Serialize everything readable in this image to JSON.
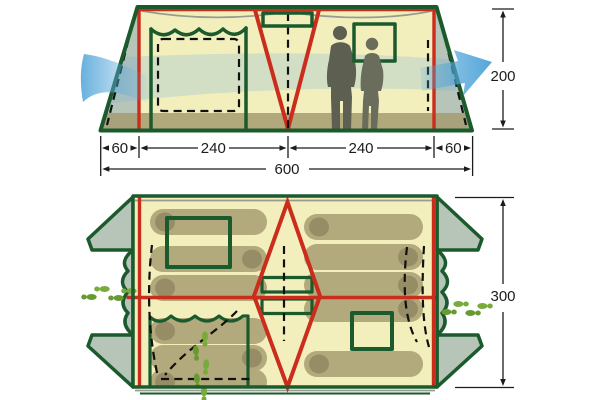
{
  "diagram": {
    "subject": "tent-specification-diagram",
    "views": {
      "front_elevation": "front-elevation-view",
      "floor_plan": "floor-plan-view"
    }
  },
  "dimensions": {
    "front_view": {
      "left_vestibule_width": "60",
      "left_room_width": "240",
      "right_room_width": "240",
      "right_vestibule_width": "60",
      "total_width": "600",
      "height": "200"
    },
    "floor_plan": {
      "depth": "300"
    }
  },
  "colors": {
    "outline_green": "#1a5a2c",
    "frame_red": "#cb2d1c",
    "canvas_yellow": "#f3efbc",
    "panel_green": "#b7c4b8",
    "ground_olive": "#a49b71",
    "bag_olive": "#b2a97c",
    "bag_head": "#968d67",
    "airflow_blue": "#57a8da",
    "footprint_green": "#79ab3c",
    "dimension_ink": "#1c1c1c"
  },
  "icons": {
    "airflow": "wind-arrow-icon",
    "footprints": "footprints-icon",
    "people": "people-silhouette-icon"
  }
}
